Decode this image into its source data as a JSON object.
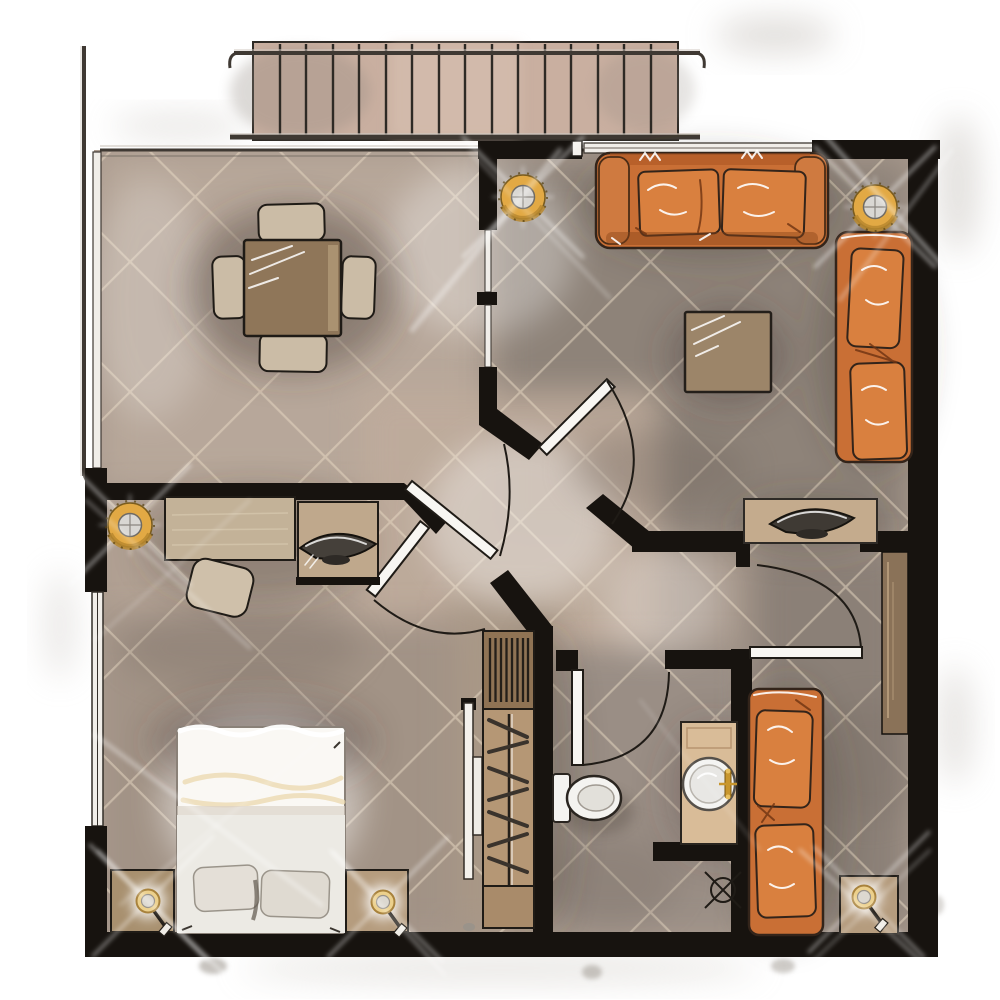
{
  "meta": {
    "title": "Apartment Floor Plan — Hand-drawn Watercolor",
    "type": "architectural-floor-plan",
    "view": "top-down",
    "orientation": "square"
  },
  "palette": {
    "paper": "#ffffff",
    "ink": "#1f1b16",
    "wall": "#17130f",
    "glass": "#f1eee9",
    "rail_metal": "#3f3933",
    "deck_wood": "#c9afa0",
    "plank_line": "#2e2a25",
    "floor_base": "#a99a8e",
    "floor_dining": "#b7a79a",
    "floor_living": "#8e8379",
    "floor_office": "#b1a093",
    "floor_hall": "#bfac9c",
    "floor_bedroom": "#a29386",
    "floor_closet": "#a89786",
    "floor_wc": "#9a8e85",
    "floor_right": "#8b8077",
    "tile_line": "#e8d9c3",
    "sofa_orange": "#c96f35",
    "pillow_orange": "#d9803f",
    "cushion_shadow": "#6e3312",
    "table_wood": "#8f7659",
    "light_wood": "#c3b298",
    "cabinet_wood": "#8a7258",
    "chair_tan": "#cbbca6",
    "vanity_wood": "#d9bc98",
    "bed_white": "#faf8f4",
    "linen_cream": "#ecd9ae",
    "fixture_white": "#f4f3f0",
    "lamp_gold": "#e2a944",
    "metal_inner": "#d9d7d3",
    "shadow": "#4a4038"
  },
  "rooms": [
    {
      "id": "balcony",
      "label": "balcony-deck",
      "furniture": [
        "wood-plank-deck",
        "metal-railing"
      ]
    },
    {
      "id": "dining",
      "label": "dining-area",
      "furniture": [
        "square-dining-table",
        "dining-chair-top",
        "dining-chair-bottom",
        "dining-chair-left",
        "dining-chair-right"
      ]
    },
    {
      "id": "living",
      "label": "living-room",
      "furniture": [
        "three-seat-sofa",
        "two-sofa-pillows",
        "square-coffee-table",
        "chaise-lounge",
        "two-chaise-pillows",
        "console-table",
        "decor-bowl"
      ]
    },
    {
      "id": "office",
      "label": "office-nook",
      "furniture": [
        "desk",
        "desk-chair",
        "side-cabinet",
        "decor-bowl"
      ]
    },
    {
      "id": "hallway",
      "label": "central-hallway",
      "furniture": [
        "pinwheel-door-walls"
      ]
    },
    {
      "id": "bedroom",
      "label": "bedroom",
      "furniture": [
        "double-bed-white-duvet",
        "two-pillows",
        "nightstand-left",
        "nightstand-right",
        "table-lamp-left",
        "table-lamp-right"
      ]
    },
    {
      "id": "closet",
      "label": "wardrobe-corridor",
      "furniture": [
        "shelved-wardrobe-top",
        "hanging-rail-with-hangers",
        "sliding-mirror-doors"
      ]
    },
    {
      "id": "wc",
      "label": "toilet-room",
      "furniture": [
        "toilet"
      ]
    },
    {
      "id": "bathroom",
      "label": "bathroom",
      "furniture": [
        "vanity-counter",
        "round-washbasin",
        "gold-faucet",
        "floor-drain-symbol"
      ]
    },
    {
      "id": "second-room",
      "label": "second-room",
      "furniture": [
        "orange-daybed",
        "two-daybed-pillows",
        "tall-cabinet",
        "nightstand",
        "table-lamp"
      ]
    }
  ],
  "lighting": {
    "wall_sconces": 3,
    "table_lamps": 3,
    "light_flares": "white cross streaks"
  },
  "doors": {
    "hinged_arc_doors": 6,
    "sliding_glass_panels": 2,
    "closet_sliders": 2
  },
  "balcony": {
    "planks": 16,
    "railings": 3,
    "rail_hooks": "curled ends"
  }
}
